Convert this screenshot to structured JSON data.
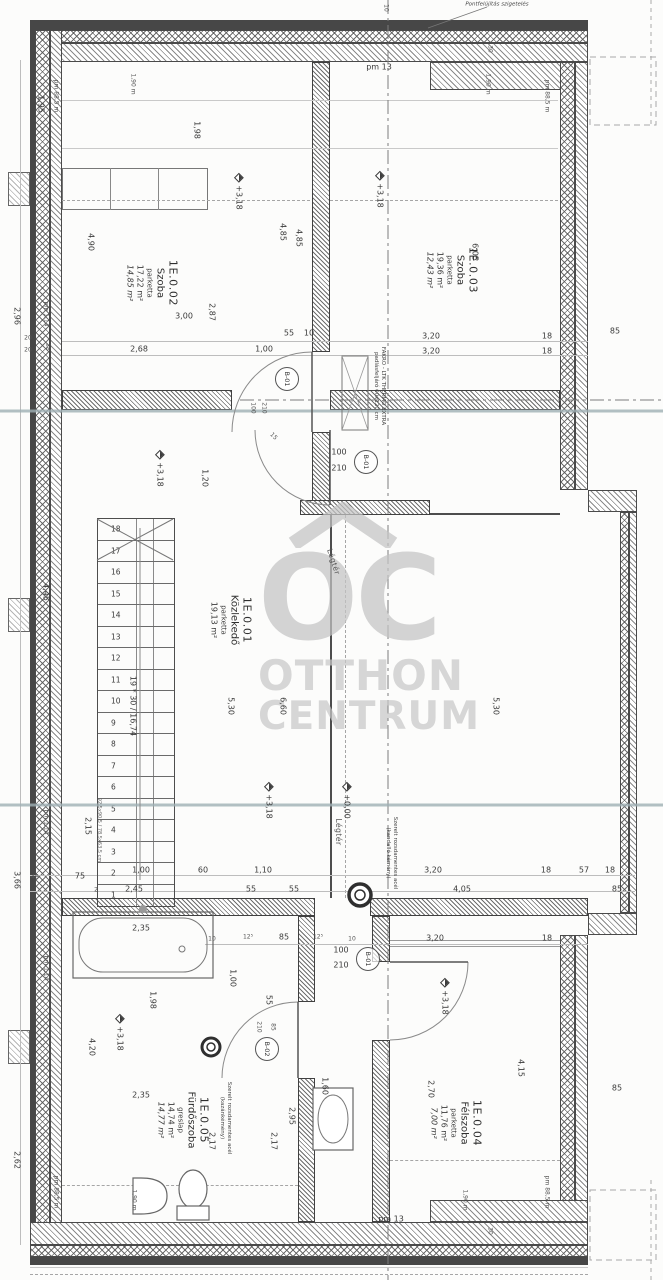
{
  "watermark": {
    "logo_letters": "OC",
    "word1": "OTTHON",
    "word2": "CENTRUM",
    "color": "#c4c4c4"
  },
  "rooms": [
    {
      "id": "1E.0.02",
      "name": "Szoba",
      "floor": "parketta",
      "area": "17,22 m²",
      "area2": "14,85 m²",
      "x": 152,
      "y": 283
    },
    {
      "id": "1E.0.03",
      "name": "Szoba",
      "floor": "parketta",
      "area": "19,36 m²",
      "area2": "12,43 m²",
      "x": 452,
      "y": 270
    },
    {
      "id": "1E.0.01",
      "name": "Közlekedő",
      "floor": "parketta",
      "area": "19,13 m²",
      "area2": "",
      "x": 231,
      "y": 620
    },
    {
      "id": "1E.0.05",
      "name": "Fürdőszoba",
      "floor": "greslap",
      "area": "14,74 m²",
      "area2": "14,77 m²",
      "x": 183,
      "y": 1120
    },
    {
      "id": "1E.0.04",
      "name": "Félszoba",
      "floor": "parketta",
      "area": "11,76 m²",
      "area2": "7,00 m²",
      "x": 456,
      "y": 1123
    }
  ],
  "stairs": {
    "steps": [
      "1",
      "2",
      "3",
      "4",
      "5",
      "6",
      "7",
      "8",
      "9",
      "10",
      "11",
      "12",
      "13",
      "14",
      "15",
      "16",
      "17",
      "18"
    ],
    "note": "19 * 30 / 16,74"
  },
  "door_tags": [
    {
      "label": "B-01",
      "x": 287,
      "y": 379
    },
    {
      "label": "B-01",
      "x": 366,
      "y": 462
    },
    {
      "label": "B-01",
      "x": 368,
      "y": 959
    },
    {
      "label": "B-02",
      "x": 267,
      "y": 1049
    }
  ],
  "notes": [
    {
      "t": "Szerelt rozsdamentes acél",
      "t2": "(kandalló kémény)",
      "x": 391,
      "y": 853,
      "r": 90
    },
    {
      "t": "Szerelt rozsdamentes acél",
      "t2": "(kazánkémény)",
      "x": 225,
      "y": 1118,
      "r": 90
    },
    {
      "t": "FAKRO - LTK THERMO EXTRA",
      "t2": "padlásfeljáró 60x120 cm",
      "x": 379,
      "y": 386,
      "r": 90
    },
    {
      "t": "Pontfelújítás szigetelés",
      "x": 497,
      "y": 5,
      "r": 0,
      "c": "it"
    }
  ],
  "dims": [
    {
      "t": "1,95",
      "x": 40,
      "y": 104,
      "r": 90
    },
    {
      "t": "pm 88,5 m",
      "x": 55,
      "y": 96,
      "r": 90,
      "c": "xs"
    },
    {
      "t": "1,90 m",
      "x": 132,
      "y": 84,
      "r": 90,
      "c": "xs"
    },
    {
      "t": "1,98",
      "x": 196,
      "y": 130,
      "r": 90
    },
    {
      "t": "+3,18",
      "x": 238,
      "y": 192,
      "r": 90,
      "c": "lvl"
    },
    {
      "t": "4,90",
      "x": 90,
      "y": 242,
      "r": 90
    },
    {
      "t": "4,85",
      "x": 282,
      "y": 232,
      "r": 90
    },
    {
      "t": "4,85",
      "x": 298,
      "y": 238,
      "r": 90
    },
    {
      "t": "2,87",
      "x": 211,
      "y": 312,
      "r": 90
    },
    {
      "t": "3,00",
      "x": 184,
      "y": 317,
      "r": 0
    },
    {
      "t": "2,68",
      "x": 139,
      "y": 350,
      "r": 0
    },
    {
      "t": "1,00",
      "x": 264,
      "y": 350,
      "r": 0
    },
    {
      "t": "55",
      "x": 289,
      "y": 334,
      "r": 0
    },
    {
      "t": "10",
      "x": 309,
      "y": 334,
      "r": 0
    },
    {
      "t": "2,96",
      "x": 16,
      "y": 316,
      "r": 90
    },
    {
      "t": "pm 1,14",
      "x": 45,
      "y": 314,
      "r": 90,
      "c": "xs"
    },
    {
      "t": "20",
      "x": 28,
      "y": 339,
      "r": 0,
      "c": "xs"
    },
    {
      "t": "20",
      "x": 28,
      "y": 351,
      "r": 0,
      "c": "xs"
    },
    {
      "t": "18",
      "x": 47,
      "y": 347,
      "r": 90,
      "c": "xs"
    },
    {
      "t": "1,90 m",
      "x": 487,
      "y": 84,
      "r": 90,
      "c": "xs"
    },
    {
      "t": "pm 88,5 m",
      "x": 546,
      "y": 96,
      "r": 90,
      "c": "xs"
    },
    {
      "t": "+3,18",
      "x": 379,
      "y": 190,
      "r": 90,
      "c": "lvl"
    },
    {
      "t": "6,05",
      "x": 474,
      "y": 252,
      "r": 90
    },
    {
      "t": "3,20",
      "x": 431,
      "y": 337,
      "r": 0
    },
    {
      "t": "3,20",
      "x": 431,
      "y": 352,
      "r": 0
    },
    {
      "t": "18",
      "x": 547,
      "y": 337,
      "r": 0
    },
    {
      "t": "18",
      "x": 547,
      "y": 352,
      "r": 0
    },
    {
      "t": "85",
      "x": 615,
      "y": 332,
      "r": 0
    },
    {
      "t": "pm 13",
      "x": 379,
      "y": 68,
      "r": 0
    },
    {
      "t": "10",
      "x": 385,
      "y": 8,
      "r": 90,
      "c": "xs"
    },
    {
      "t": "30",
      "x": 489,
      "y": 49,
      "r": 90,
      "c": "xs"
    },
    {
      "t": "100",
      "x": 252,
      "y": 408,
      "r": 90,
      "c": "xs"
    },
    {
      "t": "210",
      "x": 263,
      "y": 408,
      "r": 90,
      "c": "xs"
    },
    {
      "t": "15",
      "x": 273,
      "y": 437,
      "r": 45,
      "c": "xs"
    },
    {
      "t": "100",
      "x": 339,
      "y": 453,
      "r": 0
    },
    {
      "t": "210",
      "x": 339,
      "y": 469,
      "r": 0
    },
    {
      "t": "1,20",
      "x": 204,
      "y": 478,
      "r": 90
    },
    {
      "t": "+3,18",
      "x": 159,
      "y": 469,
      "r": 90,
      "c": "lvl"
    },
    {
      "t": "4,45",
      "x": 45,
      "y": 592,
      "r": 90
    },
    {
      "t": "5,30",
      "x": 230,
      "y": 706,
      "r": 90
    },
    {
      "t": "6,60",
      "x": 282,
      "y": 706,
      "r": 90
    },
    {
      "t": "5,30",
      "x": 495,
      "y": 706,
      "r": 90
    },
    {
      "t": "19 * 30 / 16,74",
      "x": 132,
      "y": 706,
      "r": 90
    },
    {
      "t": "2,15",
      "x": 87,
      "y": 826,
      "r": 90
    },
    {
      "t": "pm 1,14",
      "x": 45,
      "y": 822,
      "r": 90,
      "c": "xs"
    },
    {
      "t": "+3,18",
      "x": 268,
      "y": 801,
      "r": 90,
      "c": "lvl"
    },
    {
      "t": "+0,00",
      "x": 346,
      "y": 801,
      "r": 90,
      "c": "lvl"
    },
    {
      "t": "92,5x90,5 / 78,5x63,5 cm",
      "x": 98,
      "y": 830,
      "r": 90,
      "c": "xxs"
    },
    {
      "t": "Légtér",
      "x": 333,
      "y": 562,
      "r": 72,
      "c": "air"
    },
    {
      "t": "Légtér",
      "x": 338,
      "y": 832,
      "r": 90,
      "c": "air"
    },
    {
      "t": "3,66",
      "x": 16,
      "y": 880,
      "r": 90
    },
    {
      "t": "48",
      "x": 35,
      "y": 878,
      "r": 0,
      "c": "xs"
    },
    {
      "t": "75",
      "x": 80,
      "y": 877,
      "r": 0
    },
    {
      "t": "2",
      "x": 96,
      "y": 891,
      "r": 0,
      "c": "xs"
    },
    {
      "t": "1,00",
      "x": 141,
      "y": 871,
      "r": 0
    },
    {
      "t": "2,45",
      "x": 134,
      "y": 890,
      "r": 0
    },
    {
      "t": "60",
      "x": 203,
      "y": 871,
      "r": 0
    },
    {
      "t": "1,10",
      "x": 263,
      "y": 871,
      "r": 0
    },
    {
      "t": "55",
      "x": 251,
      "y": 890,
      "r": 0
    },
    {
      "t": "55",
      "x": 294,
      "y": 890,
      "r": 0
    },
    {
      "t": "3,20",
      "x": 433,
      "y": 871,
      "r": 0
    },
    {
      "t": "4,05",
      "x": 462,
      "y": 890,
      "r": 0
    },
    {
      "t": "18",
      "x": 546,
      "y": 871,
      "r": 0
    },
    {
      "t": "57",
      "x": 584,
      "y": 871,
      "r": 0
    },
    {
      "t": "18",
      "x": 610,
      "y": 871,
      "r": 0
    },
    {
      "t": "85",
      "x": 617,
      "y": 890,
      "r": 0
    },
    {
      "t": "2,35",
      "x": 141,
      "y": 929,
      "r": 0
    },
    {
      "t": "10",
      "x": 212,
      "y": 940,
      "r": 0,
      "c": "xs"
    },
    {
      "t": "12⁵",
      "x": 248,
      "y": 938,
      "r": 0,
      "c": "xs"
    },
    {
      "t": "85",
      "x": 284,
      "y": 938,
      "r": 0
    },
    {
      "t": "12⁵",
      "x": 318,
      "y": 938,
      "r": 0,
      "c": "xs"
    },
    {
      "t": "10",
      "x": 352,
      "y": 940,
      "r": 0,
      "c": "xs"
    },
    {
      "t": "100",
      "x": 341,
      "y": 951,
      "r": 0
    },
    {
      "t": "210",
      "x": 341,
      "y": 966,
      "r": 0
    },
    {
      "t": "3,20",
      "x": 435,
      "y": 939,
      "r": 0
    },
    {
      "t": "18",
      "x": 547,
      "y": 939,
      "r": 0
    },
    {
      "t": "1,98",
      "x": 152,
      "y": 1000,
      "r": 90
    },
    {
      "t": "1,00",
      "x": 232,
      "y": 978,
      "r": 90
    },
    {
      "t": "55",
      "x": 268,
      "y": 1000,
      "r": 90
    },
    {
      "t": "210",
      "x": 258,
      "y": 1027,
      "r": 90,
      "c": "xs"
    },
    {
      "t": "85",
      "x": 272,
      "y": 1027,
      "r": 90,
      "c": "xs"
    },
    {
      "t": "+3,18",
      "x": 119,
      "y": 1033,
      "r": 90,
      "c": "lvl"
    },
    {
      "t": "4,20",
      "x": 91,
      "y": 1047,
      "r": 90
    },
    {
      "t": "+3,18",
      "x": 444,
      "y": 997,
      "r": 90,
      "c": "lvl"
    },
    {
      "t": "2,35",
      "x": 141,
      "y": 1096,
      "r": 0
    },
    {
      "t": "1,60",
      "x": 324,
      "y": 1086,
      "r": 90
    },
    {
      "t": "2,70",
      "x": 430,
      "y": 1089,
      "r": 90
    },
    {
      "t": "4,15",
      "x": 520,
      "y": 1068,
      "r": 90
    },
    {
      "t": "2,17",
      "x": 211,
      "y": 1141,
      "r": 90
    },
    {
      "t": "2,95",
      "x": 291,
      "y": 1116,
      "r": 90
    },
    {
      "t": "2,17",
      "x": 273,
      "y": 1141,
      "r": 90
    },
    {
      "t": "85",
      "x": 617,
      "y": 1089,
      "r": 0
    },
    {
      "t": "2,62",
      "x": 16,
      "y": 1160,
      "r": 90
    },
    {
      "t": "pm 1,14",
      "x": 45,
      "y": 968,
      "r": 90,
      "c": "xs"
    },
    {
      "t": "pm 88,5 m",
      "x": 55,
      "y": 1192,
      "r": 90,
      "c": "xs"
    },
    {
      "t": "1,90 m",
      "x": 133,
      "y": 1200,
      "r": 90,
      "c": "xs"
    },
    {
      "t": "1,90 m",
      "x": 464,
      "y": 1200,
      "r": 90,
      "c": "xs"
    },
    {
      "t": "pm 88,5 m",
      "x": 546,
      "y": 1192,
      "r": 90,
      "c": "xs"
    },
    {
      "t": "pm 13",
      "x": 391,
      "y": 1220,
      "r": 0
    },
    {
      "t": "30",
      "x": 489,
      "y": 1231,
      "r": 90,
      "c": "xs"
    }
  ]
}
